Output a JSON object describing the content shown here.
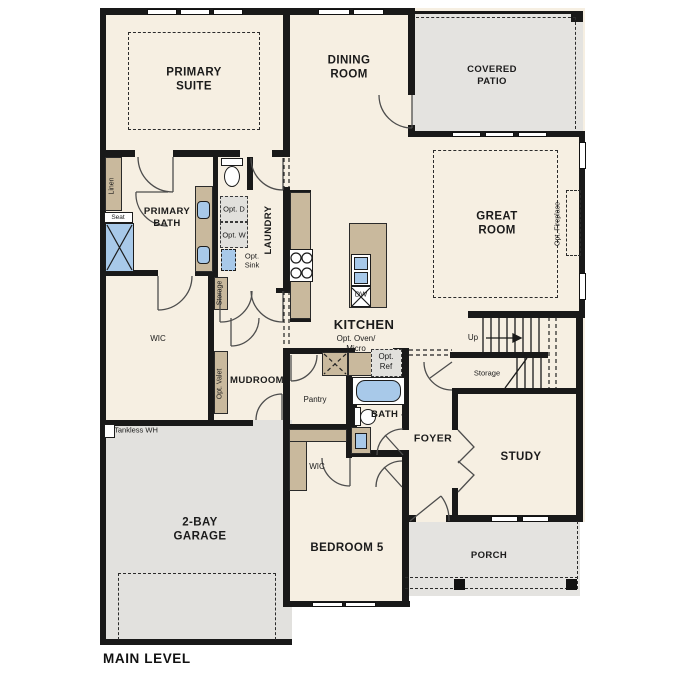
{
  "plan": {
    "caption": "MAIN LEVEL",
    "rooms": {
      "primary_suite": "PRIMARY SUITE",
      "dining_room": "DINING ROOM",
      "covered_patio": "COVERED PATIO",
      "great_room": "GREAT ROOM",
      "primary_bath": "PRIMARY BATH",
      "laundry": "LAUNDRY",
      "wic_primary": "WIC",
      "mudroom": "MUDROOM",
      "kitchen": "KITCHEN",
      "pantry": "Pantry",
      "bath_4": "BATH 4",
      "foyer": "FOYER",
      "study": "STUDY",
      "storage_stairs": "Storage",
      "storage_hall": "Storage",
      "wic_bedroom5": "WIC",
      "bedroom_5": "BEDROOM 5",
      "garage": "2-BAY GARAGE",
      "porch": "PORCH"
    },
    "fixtures": {
      "linen": "Linen",
      "seat": "Seat",
      "opt_dryer": "Opt. D",
      "opt_washer": "Opt. W",
      "opt_sink": "Opt. Sink",
      "opt_valet": "Opt. Valet",
      "opt_oven_micro": "Opt. Oven/ Micro",
      "opt_ref": "Opt. Ref",
      "opt_fireplace": "Opt. Fireplace",
      "tankless_wh": "Tankless WH",
      "dishwasher": "DW",
      "stairs_up": "Up"
    },
    "colors": {
      "wall": "#191919",
      "interior_floor": "#f6efe2",
      "outdoor_floor": "#e4e3e0",
      "cabinet": "#c9b99d",
      "fixture_blue": "#a8c9e9"
    }
  }
}
